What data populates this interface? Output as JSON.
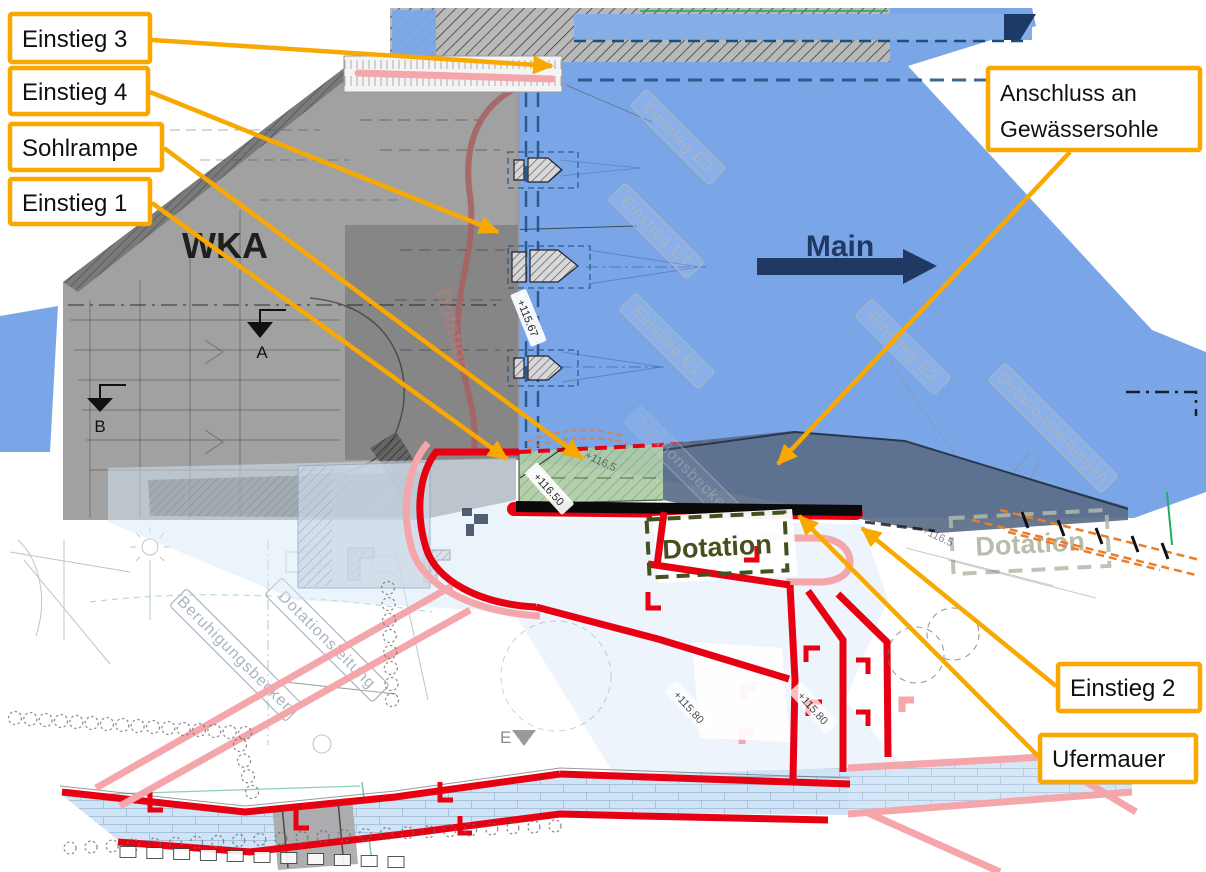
{
  "callouts": {
    "einstieg3": "Einstieg 3",
    "einstieg4": "Einstieg 4",
    "sohlrampe": "Sohlrampe",
    "einstieg1": "Einstieg 1",
    "anschluss_line1": "Anschluss an",
    "anschluss_line2": "Gewässersohle",
    "einstieg2": "Einstieg 2",
    "ufermauer": "Ufermauer"
  },
  "plan": {
    "wka": "WKA",
    "river": "Main",
    "dotation": "Dotation",
    "dotation_faded": "Dotation",
    "dotation_channel": "Dotation",
    "section_a": "A",
    "section_b": "B",
    "section_e": "E"
  },
  "watermarks": {
    "e3": "Einstieg E3",
    "e4": "Einstieg E4",
    "e1": "Einstieg E1",
    "e2": "Einstieg E2",
    "dotationsleitungen": "Dotationsleitungen",
    "dotationsbecken": "Dotationsbecken",
    "beruhigungsbecken": "Beruhigungsbecken",
    "dotationsleitung": "Dotationsleitung"
  },
  "elevations": {
    "p11567": "+115.67",
    "p11650": "+116.50",
    "p11580a": "+115.80",
    "p11580b": "+115.80",
    "p1165a": "+116.5",
    "p1165b": "+116.5"
  },
  "colors": {
    "orange": "#F9A800",
    "water": "#7AA6E8",
    "navy": "#1F3864",
    "dashnavy": "#1F4E79",
    "red": "#E60012",
    "pink": "#F4A6AA",
    "darkred": "#A86060",
    "green": "#AECBA4",
    "slate": "#5A6C88",
    "olive": "#46501E",
    "fadedolive": "#A9B29F",
    "building": "#9C9C9C",
    "lightblue": "#D7E7F7",
    "brickbg": "#CFE4F6",
    "brickline": "#A9C2DA",
    "watermark": "#A9B4C0",
    "orangedash": "#E87D2A"
  }
}
